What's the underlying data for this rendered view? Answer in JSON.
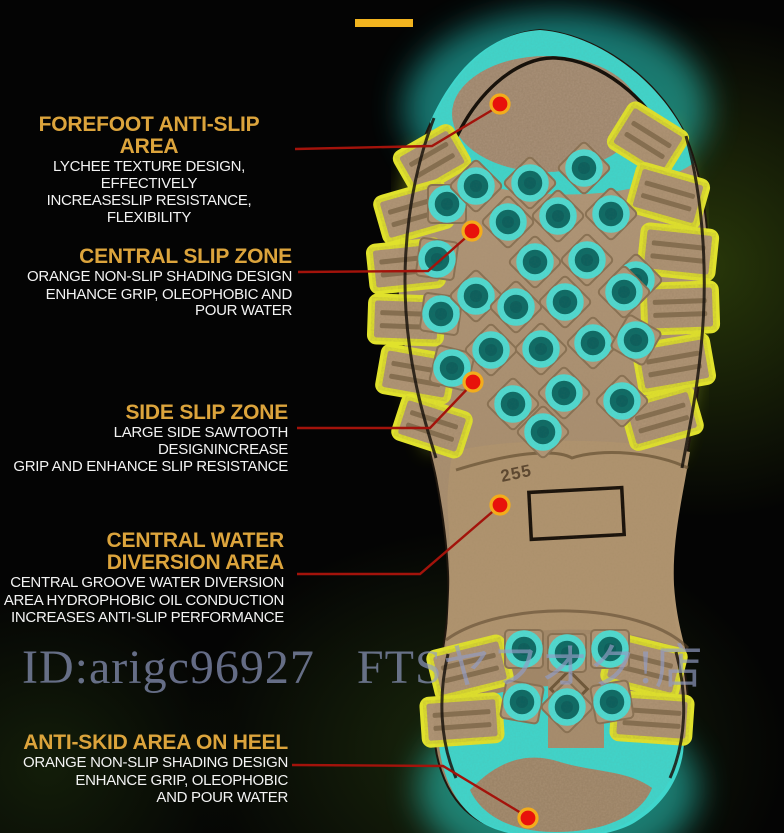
{
  "colors": {
    "accent_gold": "#dca43c",
    "callout_red": "#e8120b",
    "dot_ring_orange": "#f2ac1c",
    "glow_cyan": "#45d8cd",
    "glow_yellow": "#dfe12b",
    "sole_tan": "#b29778",
    "top_bar_gold": "#f2b41f"
  },
  "callouts": [
    {
      "title_lines": [
        "FOREFOOT ANTI-SLIP AREA"
      ],
      "body_lines": [
        "LYCHEE TEXTURE DESIGN, EFFECTIVELY",
        "INCREASESLIP RESISTANCE, FLEXIBILITY"
      ]
    },
    {
      "title_lines": [
        "CENTRAL SLIP ZONE"
      ],
      "body_lines": [
        "ORANGE NON-SLIP SHADING DESIGN",
        "ENHANCE GRIP, OLEOPHOBIC AND POUR WATER"
      ]
    },
    {
      "title_lines": [
        "SIDE SLIP ZONE"
      ],
      "body_lines": [
        "LARGE SIDE SAWTOOTH DESIGNINCREASE",
        "GRIP AND ENHANCE SLIP RESISTANCE"
      ]
    },
    {
      "title_lines": [
        "CENTRAL WATER",
        "DIVERSION AREA"
      ],
      "body_lines": [
        "CENTRAL GROOVE WATER DIVERSION",
        "AREA HYDROPHOBIC OIL CONDUCTION",
        "INCREASES ANTI-SLIP PERFORMANCE"
      ]
    },
    {
      "title_lines": [
        "ANTI-SKID AREA ON HEEL"
      ],
      "body_lines": [
        "ORANGE NON-SLIP SHADING DESIGN",
        "ENHANCE GRIP, OLEOPHOBIC",
        "AND POUR WATER"
      ]
    }
  ],
  "watermark": {
    "id_text": "ID:arigc96927",
    "store_text": "FTSヤフオク!店"
  },
  "sole": {
    "size_marking": "255"
  }
}
